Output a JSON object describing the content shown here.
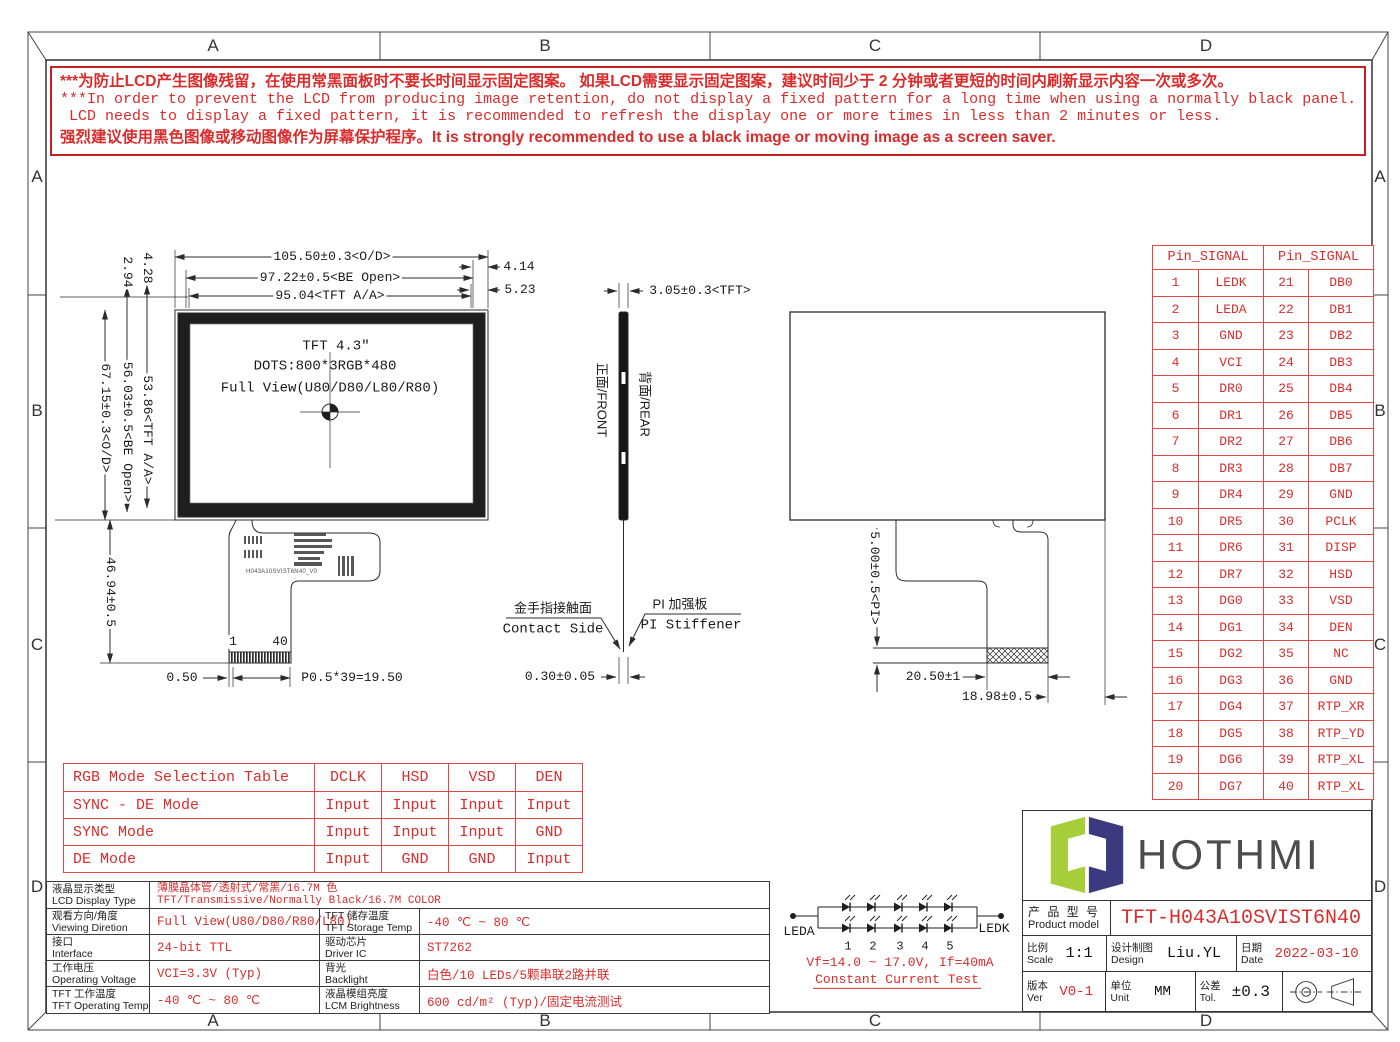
{
  "page": {
    "zones": [
      "A",
      "B",
      "C",
      "D"
    ]
  },
  "warning": {
    "lines": [
      "***为防止LCD产生图像残留，在使用常黑面板时不要长时间显示固定图案。 如果LCD需要显示固定图案，建议时间少于 2 分钟或者更短的时间内刷新显示内容一次或多次。",
      "***In order to prevent the LCD from producing image retention, do not display a fixed pattern for a long time when using a normally black panel. If the",
      " LCD needs to display a fixed pattern, it is recommended to refresh the display one or more times in less than 2 minutes or less.",
      "强烈建议使用黑色图像或移动图像作为屏幕保护程序。It is strongly recommended to use a black image or moving image as a screen saver."
    ]
  },
  "front_view": {
    "title_lines": [
      "TFT 4.3″",
      "DOTS:800*3RGB*480",
      "Full View(U80/D80/L80/R80)"
    ],
    "dims": {
      "od_w": "105.50±0.3<O/D>",
      "be_w": "97.22±0.5<BE Open>",
      "aa_w": "95.04<TFT A/A>",
      "d414": "4.14",
      "d523": "5.23",
      "v294": "2.94",
      "v428": "4.28",
      "od_h": "67.15±0.3<O/D>",
      "be_h": "56.03±0.5<BE Open>",
      "aa_h": "53.86<TFT A/A>",
      "tail_h": "46.94±0.5",
      "pin_first": "1",
      "pin_last": "40",
      "margin": "0.50",
      "pitch": "P0.5*39=19.50"
    },
    "fpc_marking": "H043A10SVIST6N40_V0"
  },
  "side_view": {
    "dim_top": "3.05±0.3<TFT>",
    "front_label": "正面/FRONT",
    "rear_label": "背面/REAR",
    "contact_cn": "金手指接触面",
    "contact_en": "Contact Side",
    "stiffener_cn": "PI 加强板",
    "stiffener_en": "PI Stiffener",
    "dim_bottom": "0.30±0.05"
  },
  "rear_view": {
    "dim_pi": "5.00±0.5<PI>",
    "dim_finger": "20.50±1",
    "dim_edge": "18.98±0.5"
  },
  "pin_table": {
    "header": "Pin_SIGNAL",
    "rows": [
      [
        "1",
        "LEDK",
        "21",
        "DB0"
      ],
      [
        "2",
        "LEDA",
        "22",
        "DB1"
      ],
      [
        "3",
        "GND",
        "23",
        "DB2"
      ],
      [
        "4",
        "VCI",
        "24",
        "DB3"
      ],
      [
        "5",
        "DR0",
        "25",
        "DB4"
      ],
      [
        "6",
        "DR1",
        "26",
        "DB5"
      ],
      [
        "7",
        "DR2",
        "27",
        "DB6"
      ],
      [
        "8",
        "DR3",
        "28",
        "DB7"
      ],
      [
        "9",
        "DR4",
        "29",
        "GND"
      ],
      [
        "10",
        "DR5",
        "30",
        "PCLK"
      ],
      [
        "11",
        "DR6",
        "31",
        "DISP"
      ],
      [
        "12",
        "DR7",
        "32",
        "HSD"
      ],
      [
        "13",
        "DG0",
        "33",
        "VSD"
      ],
      [
        "14",
        "DG1",
        "34",
        "DEN"
      ],
      [
        "15",
        "DG2",
        "35",
        "NC"
      ],
      [
        "16",
        "DG3",
        "36",
        "GND"
      ],
      [
        "17",
        "DG4",
        "37",
        "RTP_XR"
      ],
      [
        "18",
        "DG5",
        "38",
        "RTP_YD"
      ],
      [
        "19",
        "DG6",
        "39",
        "RTP_XL"
      ],
      [
        "20",
        "DG7",
        "40",
        "RTP_XL"
      ]
    ]
  },
  "rgb_table": {
    "header": [
      "RGB Mode Selection Table",
      "DCLK",
      "HSD",
      "VSD",
      "DEN"
    ],
    "rows": [
      [
        "SYNC - DE Mode",
        "Input",
        "Input",
        "Input",
        "Input"
      ],
      [
        "SYNC Mode",
        "Input",
        "Input",
        "Input",
        "GND"
      ],
      [
        "DE Mode",
        "Input",
        "GND",
        "GND",
        "Input"
      ]
    ]
  },
  "spec_table": {
    "rows": [
      {
        "label_cn": "液晶显示类型",
        "label_en": "LCD Display Type",
        "value_lines": [
          "薄膜晶体管/透射式/常黑/16.7M 色",
          "TFT/Transmissive/Normally Black/16.7M COLOR"
        ]
      },
      {
        "label_cn": "观看方向/角度",
        "label_en": "Viewing Diretion",
        "value": "Full View(U80/D80/R80/L80)",
        "label2_cn": "TFT 储存温度",
        "label2_en": "TFT Storage Temp",
        "value2": "-40 ℃ ~ 80 ℃"
      },
      {
        "label_cn": "接口",
        "label_en": "Interface",
        "value": "24-bit TTL",
        "label2_cn": "驱动芯片",
        "label2_en": "Driver IC",
        "value2": "ST7262"
      },
      {
        "label_cn": "工作电压",
        "label_en": "Operating Voltage",
        "value": "VCI=3.3V (Typ)",
        "label2_cn": "背光",
        "label2_en": "Backlight",
        "value2": "白色/10 LEDs/5颗串联2路并联"
      },
      {
        "label_cn": "TFT 工作温度",
        "label_en": "TFT Operating Temp",
        "value": "-40 ℃ ~ 80 ℃",
        "label2_cn": "液晶模组亮度",
        "label2_en": "LCM Brightness",
        "value2": "600 cd/m² (Typ)/固定电流测试"
      }
    ]
  },
  "led_circuit": {
    "anode": "LEDA",
    "cathode": "LEDK",
    "numbers": [
      "1",
      "2",
      "3",
      "4",
      "5"
    ],
    "spec": "Vf=14.0 ~ 17.0V, If=40mA",
    "test": "Constant Current Test"
  },
  "title_block": {
    "brand": "HOTHMI",
    "model_label_cn": "产 品 型 号",
    "model_label_en": "Product model",
    "model": "TFT-H043A10SVIST6N40",
    "scale_cn": "比例",
    "scale_en": "Scale",
    "scale": "1:1",
    "design_cn": "设计制图",
    "design_en": "Design",
    "designer": "Liu.YL",
    "date_cn": "日期",
    "date_en": "Date",
    "date": "2022-03-10",
    "ver_cn": "版本",
    "ver_en": "Ver",
    "ver": "V0-1",
    "unit_cn": "单位",
    "unit_en": "Unit",
    "unit": "MM",
    "tol_cn": "公差",
    "tol_en": "Tol.",
    "tol": "±0.3"
  },
  "colors": {
    "red": "#d92c2c",
    "table_red": "#e04848",
    "line": "#2b2b2b",
    "logo_green": "#a6ce39",
    "logo_navy": "#3c3a7e",
    "brand_gray": "#4c4c4c"
  }
}
